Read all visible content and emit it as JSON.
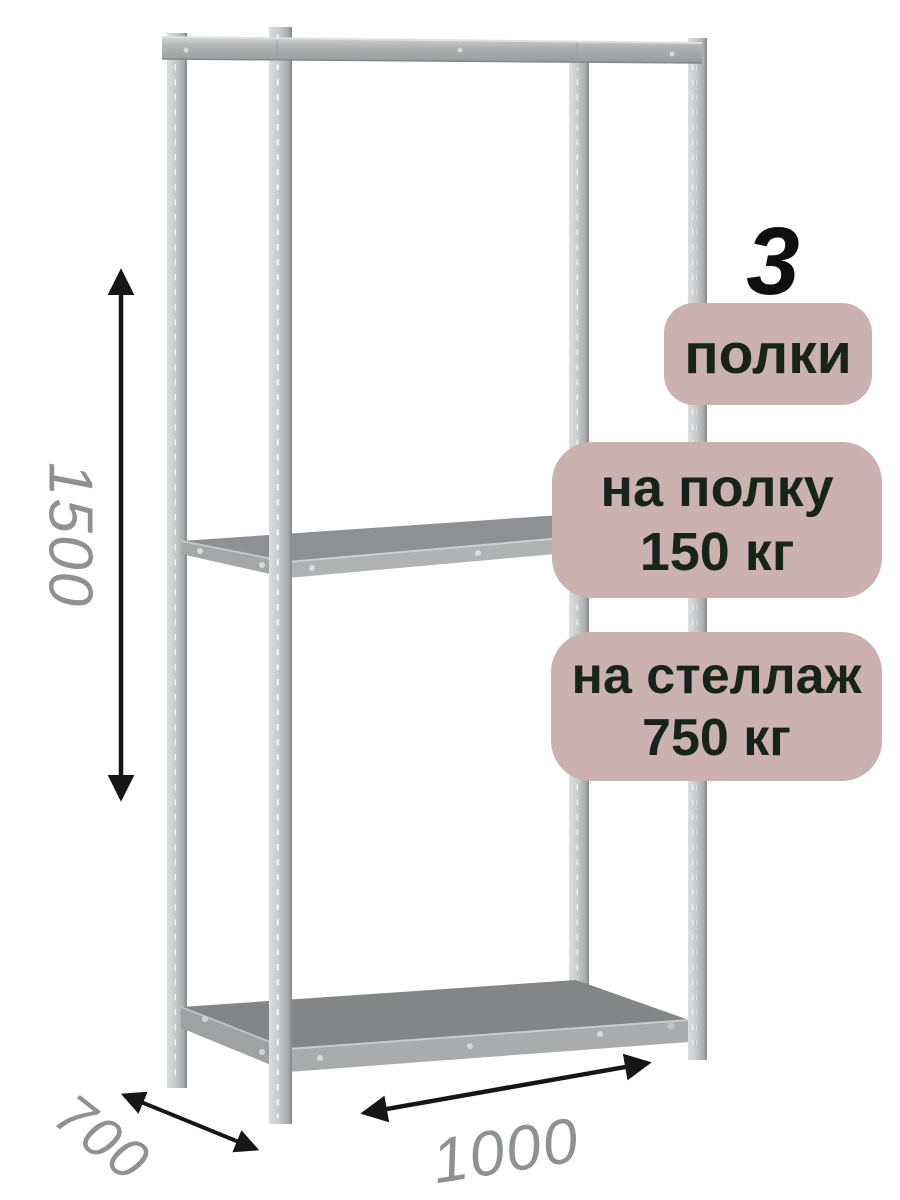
{
  "product_card": {
    "shelf_count": {
      "value": "3",
      "label": "полки"
    },
    "load_per_shelf": {
      "label": "на полку",
      "value": "150 кг"
    },
    "load_per_rack": {
      "label": "на стеллаж",
      "value": "750 кг"
    }
  },
  "dimensions": {
    "height_mm": "1500",
    "depth_mm": "700",
    "width_mm": "1000"
  },
  "colors": {
    "background": "#ffffff",
    "badge_background": "#ccb1b1",
    "badge_text": "#17241c",
    "dimension_text": "#8f9193",
    "arrow": "#161616",
    "metal_light": "#d8dadc",
    "metal_dark": "#8f9193",
    "shelf_surface_middle": "#8e9093",
    "shelf_surface_bottom": "#838587"
  }
}
